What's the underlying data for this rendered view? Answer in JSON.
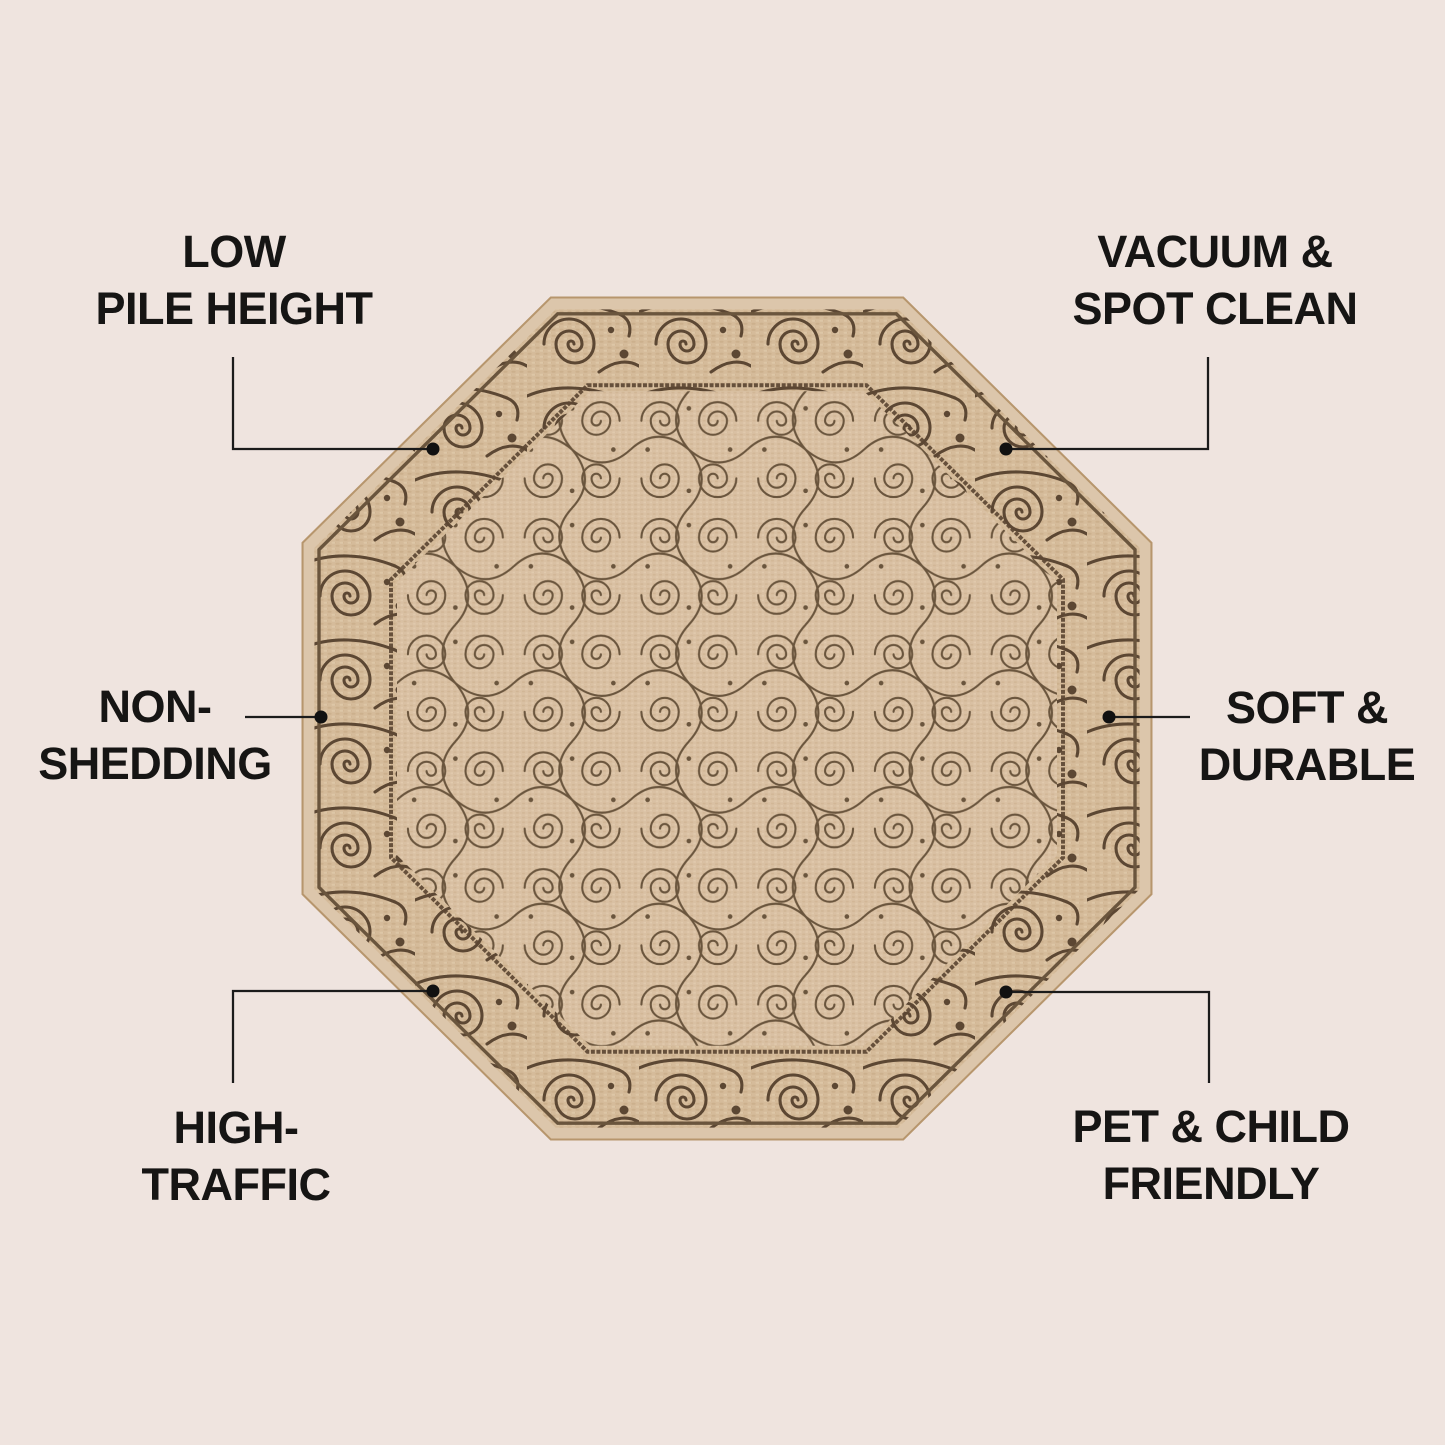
{
  "page": {
    "background_color": "#efe4df",
    "text_color": "#161514",
    "connector_color": "#1b1b1b"
  },
  "rug": {
    "name": "octagonal-scroll-area-rug",
    "shape": "octagon",
    "base_color": "#d9c0a2",
    "pattern_color": "#6a553d",
    "border_line_color": "#5c4733",
    "edge_color": "#dcc6ab"
  },
  "callouts": [
    {
      "id": "low-pile-height",
      "lines": [
        "LOW",
        "PILE HEIGHT"
      ]
    },
    {
      "id": "vacuum-spot-clean",
      "lines": [
        "VACUUM &",
        "SPOT CLEAN"
      ]
    },
    {
      "id": "non-shedding",
      "lines": [
        "NON-",
        "SHEDDING"
      ]
    },
    {
      "id": "soft-durable",
      "lines": [
        "SOFT &",
        "DURABLE"
      ]
    },
    {
      "id": "high-traffic",
      "lines": [
        "HIGH-",
        "TRAFFIC"
      ]
    },
    {
      "id": "pet-child-friendly",
      "lines": [
        "PET & CHILD",
        "FRIENDLY"
      ]
    }
  ]
}
